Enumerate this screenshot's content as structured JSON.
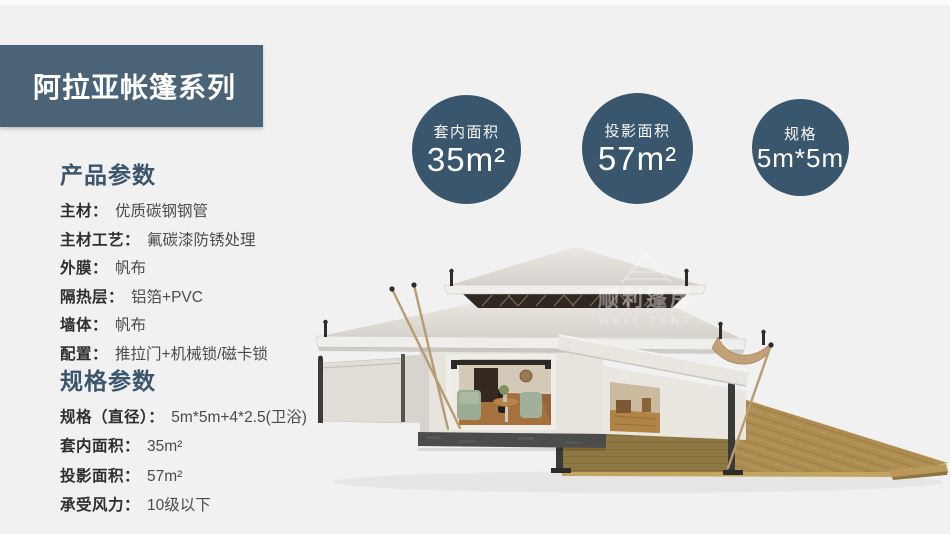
{
  "header": {
    "title": "阿拉亚帐篷系列"
  },
  "product_params": {
    "title": "产品参数",
    "rows": [
      {
        "label": "主材：",
        "value": "优质碳钢钢管"
      },
      {
        "label": "主材工艺：",
        "value": "氟碳漆防锈处理"
      },
      {
        "label": "外膜：",
        "value": "帆布"
      },
      {
        "label": "隔热层：",
        "value": "铝箔+PVC"
      },
      {
        "label": "墙体：",
        "value": "帆布"
      },
      {
        "label": "配置：",
        "value": "推拉门+机械锁/磁卡锁"
      }
    ]
  },
  "spec_params": {
    "title": "规格参数",
    "rows": [
      {
        "label": "规格（直径）：",
        "value": "5m*5m+4*2.5(卫浴)"
      },
      {
        "label": "套内面积：",
        "value": "35m²"
      },
      {
        "label": "投影面积：",
        "value": "57m²"
      },
      {
        "label": "承受风力：",
        "value": "10级以下"
      }
    ]
  },
  "badges": [
    {
      "label": "套内面积",
      "value": "35m²"
    },
    {
      "label": "投影面积",
      "value": "57m²"
    },
    {
      "label": "规格",
      "value": "5m*5m"
    }
  ],
  "watermark": {
    "cn": "顺利篷房",
    "en": "WELL TENT"
  },
  "colors": {
    "page_bg": "#f1f1f2",
    "banner_bg": "#4a6377",
    "badge_bg": "#3a566c",
    "section_title": "#3b566c",
    "label_text": "#2e2e2e",
    "value_text": "#4b4b4b",
    "canvas_roof": "#e0dcd6",
    "deck_wood": "#ad8d51"
  }
}
